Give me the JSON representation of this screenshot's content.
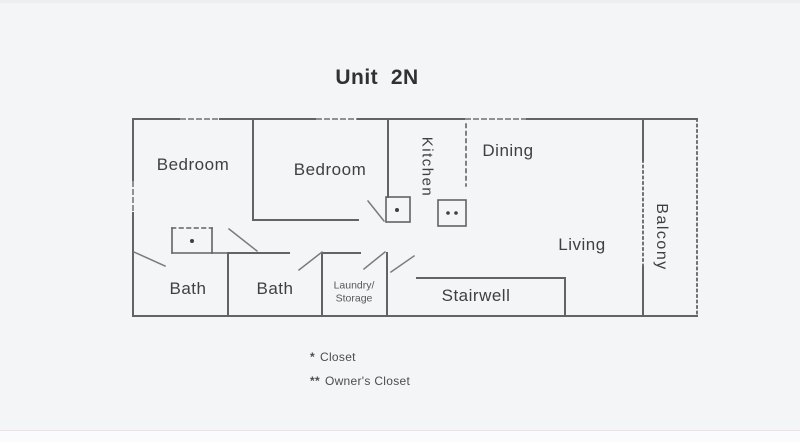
{
  "colors": {
    "background": "#f3f5f7",
    "strip_background": "#fafbfc",
    "wall": "#636363",
    "wall_light": "#8e9296",
    "text": "#3e4143"
  },
  "title": "Unit  2N",
  "rooms": {
    "bedroom1": {
      "label": "Bedroom"
    },
    "bedroom2": {
      "label": "Bedroom"
    },
    "kitchen": {
      "label": "Kitchen"
    },
    "dining": {
      "label": "Dining"
    },
    "living": {
      "label": "Living"
    },
    "balcony": {
      "label": "Balcony"
    },
    "bath1": {
      "label": "Bath"
    },
    "bath2": {
      "label": "Bath"
    },
    "laundry": {
      "label_line1": "Laundry/",
      "label_line2": "Storage"
    },
    "stairwell": {
      "label": "Stairwell"
    }
  },
  "closet_markers": {
    "bedroom1_closet": "*",
    "kitchen_closet": "*",
    "owners_closet": "**"
  },
  "legend": {
    "items": [
      {
        "marker": "*",
        "label": "Closet"
      },
      {
        "marker": "**",
        "label": "Owner's Closet"
      }
    ]
  }
}
